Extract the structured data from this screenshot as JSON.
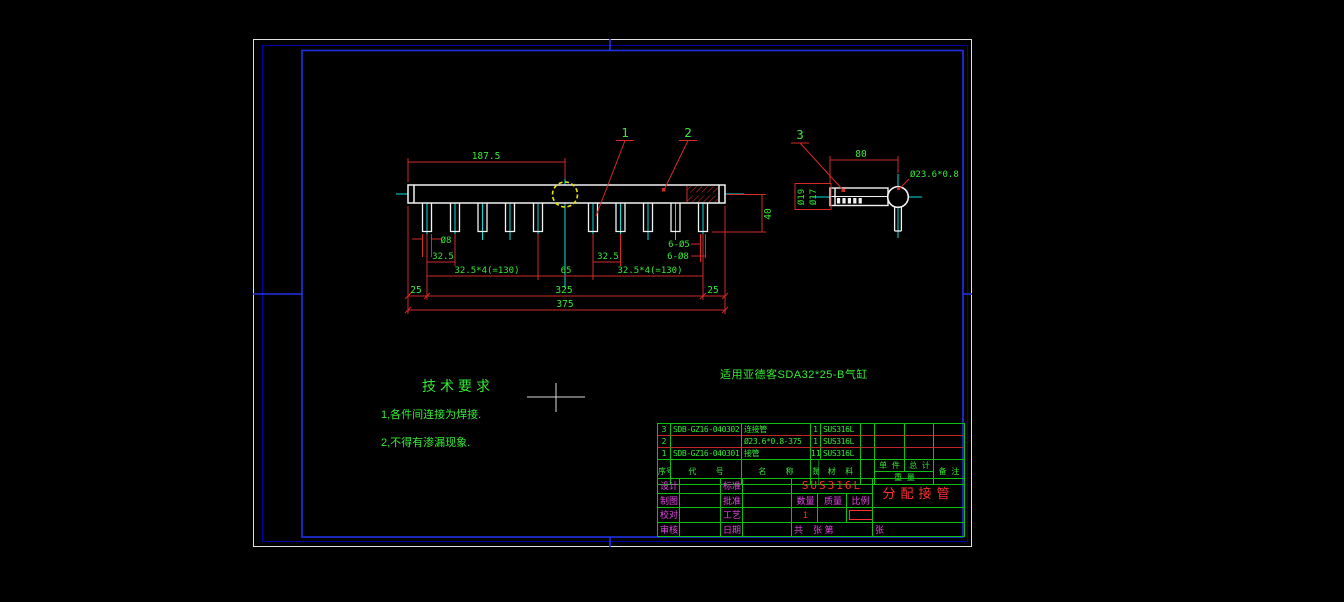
{
  "colors": {
    "geometry_white": "#f2f2f2",
    "dim_red": "#d42a2a",
    "text_green": "#35e835",
    "centerline_cyan": "#00e0e0",
    "detail_yellow": "#e6e600",
    "frame_blue": "#2230e8",
    "frame_navy": "#0000a8",
    "label_magenta": "#e346e3",
    "value_red": "#ff3030"
  },
  "balloons": {
    "item1": "1",
    "item2": "2",
    "item3": "3"
  },
  "main_view": {
    "dims": {
      "half_length": "187.5",
      "stub_height": "40",
      "stub_od": "Ø8",
      "pitch_left": "32.5",
      "pitch_group_left": "32.5*4(=130)",
      "center_gap": "65",
      "pitch_right": "32.5",
      "pitch_group_right": "32.5*4(=130)",
      "holes_small": "6-Ø5",
      "holes_large": "6-Ø8",
      "margin_left": "25",
      "span_inner": "325",
      "margin_right": "25",
      "total_length": "375"
    }
  },
  "side_view": {
    "dims": {
      "length": "80",
      "tube_spec": "Ø23.6*0.8",
      "outer_dia": "Ø19",
      "inner_dia": "Ø17"
    }
  },
  "notes": {
    "tech_title": "技术要求",
    "tech_item_1": "1,各件间连接为焊接.",
    "tech_item_2": "2,不得有渗漏现象.",
    "application": "适用亚德客SDA32*25-B气缸"
  },
  "parts_table": {
    "headers": {
      "seq": "序号",
      "code": "代    号",
      "name": "名    称",
      "qty": "数量",
      "material": "材  料",
      "unit": "单 件",
      "total": "总 计",
      "weight": "重  量",
      "remark": "备 注"
    },
    "rows": [
      {
        "seq": "3",
        "code": "SDB-GZ16-040302",
        "name": "连接管",
        "qty": "1",
        "material": "SUS316L"
      },
      {
        "seq": "2",
        "code": "",
        "name": "Ø23.6*0.8-375",
        "qty": "1",
        "material": "SUS316L"
      },
      {
        "seq": "1",
        "code": "SDB-GZ16-040301",
        "name": "接管",
        "qty": "11",
        "material": "SUS316L"
      }
    ]
  },
  "title_block": {
    "labels": {
      "design": "设计",
      "draft": "制图",
      "check": "校对",
      "review": "审核",
      "standard": "标准",
      "approve": "批准",
      "process": "工艺",
      "date": "日期",
      "qty": "数量",
      "mass": "质量",
      "scale": "比例",
      "sheet_total": "共    张 第",
      "sheet_last": "张"
    },
    "values": {
      "material": "SUS316L",
      "part_title": "分配接管",
      "qty": "1"
    }
  }
}
